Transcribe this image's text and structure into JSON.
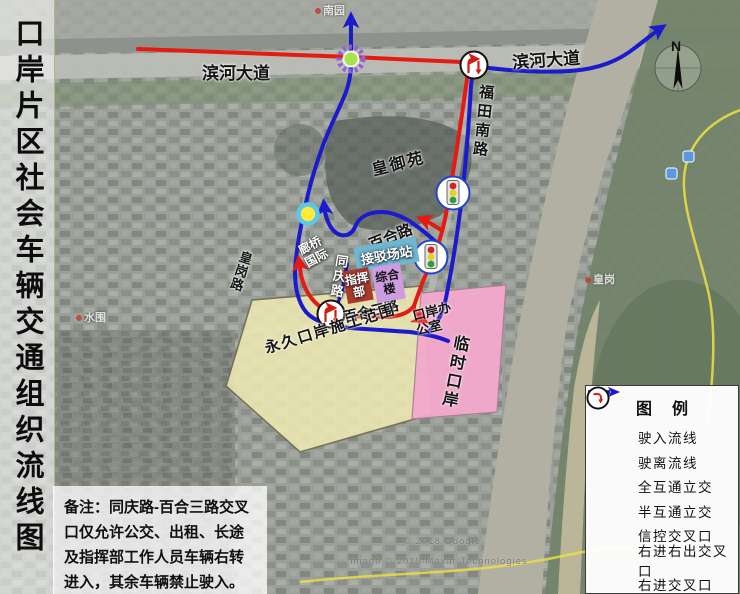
{
  "title": "口岸片区社会车辆交通组织流线图",
  "map": {
    "road_labels": [
      {
        "id": "binhe-west",
        "text": "滨河大道"
      },
      {
        "id": "binhe-east",
        "text": "滨河大道"
      },
      {
        "id": "futian-south",
        "text": "福田南路"
      },
      {
        "id": "baihe",
        "text": "百合路"
      },
      {
        "id": "tongqing",
        "text": "同庆路"
      },
      {
        "id": "huanggang-road",
        "text": "皇岗路"
      },
      {
        "id": "baihe-3rd",
        "text": "百合三路"
      }
    ],
    "place_labels": [
      {
        "id": "huangyuyuan",
        "text": "皇御苑"
      },
      {
        "id": "langqiao-intl",
        "text": "廊桥国际"
      },
      {
        "id": "port-office",
        "text": "口岸办公室"
      }
    ],
    "area_labels": [
      {
        "id": "transfer-station",
        "text": "接驳场站",
        "fill": "#6fb6d2"
      },
      {
        "id": "complex-building",
        "text": "综合楼",
        "fill": "#cf9ce0"
      },
      {
        "id": "command-post",
        "text": "指挥部",
        "fill": "#ac3a2e"
      },
      {
        "id": "permanent-port-zone",
        "text": "永久口岸施工范围",
        "fill": "#efe9b2"
      },
      {
        "id": "temporary-port",
        "text": "临时口岸",
        "fill": "#f3a9cc"
      }
    ],
    "basemap_labels": [
      {
        "text": "南园"
      },
      {
        "text": "水围"
      },
      {
        "text": "皇岗"
      }
    ],
    "compass_label": "N",
    "watermark_line1": "© 2018 Google",
    "watermark_line2": "Image © 2019 Maxar Technologies"
  },
  "note": {
    "text": "备注：同庆路-百合三路交叉口仅允许公交、出租、长途及指挥部工作人员车辆右转进入，其余车辆禁止驶入。"
  },
  "legend": {
    "title": "图 例",
    "items": [
      {
        "icon": "entry-arrow",
        "label": "驶入流线",
        "color": "#e41b12"
      },
      {
        "icon": "exit-arrow",
        "label": "驶离流线",
        "color": "#1b1bcd"
      },
      {
        "icon": "full-interchange",
        "label": "全互通立交",
        "fill": "#a8e24c",
        "ring": "#9161d8"
      },
      {
        "icon": "half-interchange",
        "label": "半互通立交",
        "fill": "#ffe93a",
        "ring": "#5bc8ea"
      },
      {
        "icon": "signal-intersection",
        "label": "信控交叉口",
        "ring": "#2244cc"
      },
      {
        "icon": "right-in-right-out",
        "label": "右进右出交叉口",
        "color": "#d11a10"
      },
      {
        "icon": "right-in",
        "label": "右进交叉口",
        "color": "#d11a10"
      }
    ]
  }
}
